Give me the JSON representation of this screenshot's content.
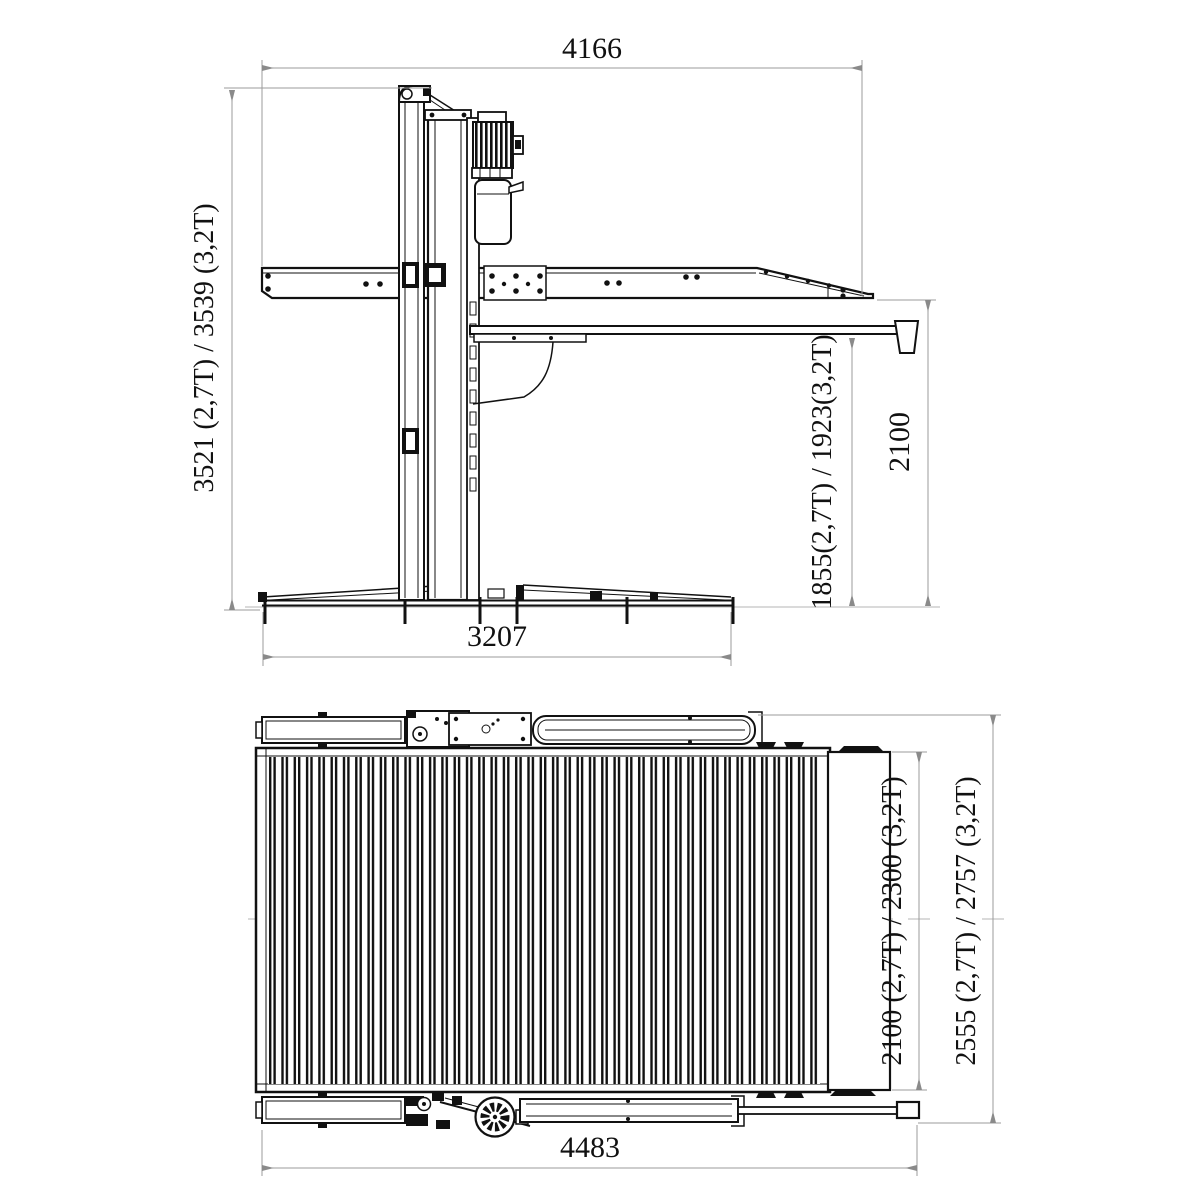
{
  "side_view": {
    "dims": {
      "top_width": "4166",
      "overall_height": "3521 (2,7T) / 3539 (3,2T)",
      "under_platform_clearance": "1855(2,7T) / 1923(3,2T)",
      "arm_height": "2100",
      "base_length": "3207"
    }
  },
  "plan_view": {
    "dims": {
      "platform_width": "2100 (2,7T) / 2300 (3,2T)",
      "overall_width": "2555 (2,7T) / 2757 (3,2T)",
      "overall_length": "4483"
    }
  },
  "colors": {
    "line": "#111111",
    "dim_line": "#9b9b9b",
    "text": "#111111",
    "background": "#ffffff"
  }
}
